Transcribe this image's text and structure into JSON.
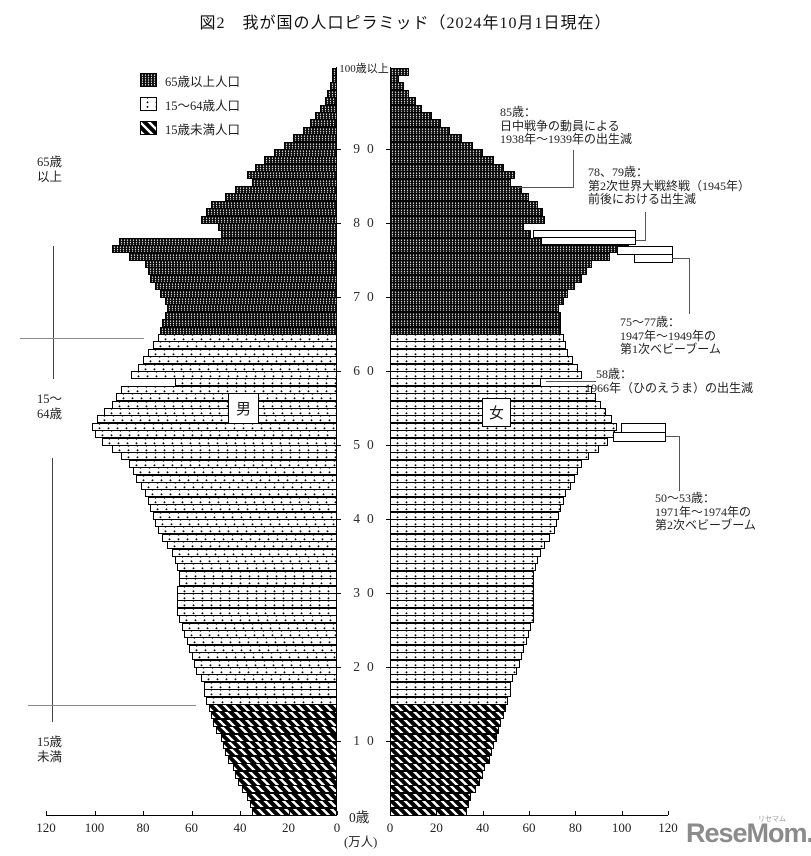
{
  "title": "図2　我が国の人口ピラミッド（2024年10月1日現在）",
  "legend": {
    "items": [
      {
        "key": "elderly",
        "label": "65歳以上人口"
      },
      {
        "key": "working",
        "label": "15～64歳人口"
      },
      {
        "key": "child",
        "label": "15歳未満人口"
      }
    ]
  },
  "side_labels": {
    "elderly": "65歳以上",
    "working": "15～64歳",
    "child": "15歳未満"
  },
  "gender": {
    "male": "男",
    "female": "女"
  },
  "axis": {
    "age_top_label": "100歳以上",
    "age_zero_label": "0歳",
    "unit_label": "(万人)",
    "age_decades": [
      90,
      80,
      70,
      60,
      50,
      40,
      30,
      20,
      10
    ],
    "x_ticks_left": [
      120,
      100,
      80,
      60,
      40,
      20,
      0
    ],
    "x_ticks_right": [
      0,
      20,
      40,
      60,
      80,
      100,
      120
    ]
  },
  "annotations": {
    "a85": {
      "lines": [
        "85歳：",
        "日中戦争の動員による",
        "1938年～1939年の出生減"
      ]
    },
    "a7879": {
      "lines": [
        "78、79歳：",
        "第2次世界大戦終戦（1945年）",
        "前後における出生減"
      ]
    },
    "a7577": {
      "lines": [
        "75～77歳：",
        "1947年～1949年の",
        "第1次ベビーブーム"
      ]
    },
    "a58": {
      "lines": [
        "58歳：",
        "1966年（ひのえうま）の出生減"
      ]
    },
    "a5053": {
      "lines": [
        "50～53歳：",
        "1971年～1974年の",
        "第2次ベビーブーム"
      ]
    }
  },
  "footer": {
    "logo": "ReseMom.",
    "logo_ruby": "リセマム"
  },
  "chart_data": {
    "type": "bar",
    "subtype": "population-pyramid",
    "title": "図2　我が国の人口ピラミッド（2024年10月1日現在）",
    "unit": "万人 per 1-year age group",
    "ages_note": "index = age in years, 0..100 (100 = 100歳以上)",
    "xlim": [
      0,
      120
    ],
    "age_groups": {
      "child": "0-14",
      "working": "15-64",
      "elderly": "65-100"
    },
    "series": [
      {
        "name": "男",
        "values": [
          35,
          36,
          37,
          39,
          41,
          42,
          43,
          45,
          46,
          47,
          48,
          50,
          51,
          52,
          53,
          54,
          55,
          55,
          56,
          58,
          59,
          60,
          61,
          62,
          63,
          64,
          65,
          66,
          66,
          66,
          66,
          65,
          65,
          66,
          67,
          68,
          70,
          72,
          74,
          75,
          76,
          77,
          78,
          79,
          81,
          83,
          84,
          86,
          89,
          93,
          97,
          100,
          101,
          99,
          96,
          93,
          91,
          89,
          67,
          85,
          82,
          80,
          78,
          76,
          74,
          73,
          72,
          71,
          70,
          71,
          73,
          75,
          77,
          78,
          79,
          86,
          93,
          90,
          48,
          49,
          56,
          54,
          52,
          46,
          42,
          35,
          37,
          34,
          30,
          26,
          22,
          18,
          14,
          11,
          9,
          7,
          5,
          4,
          3,
          2,
          2
        ]
      },
      {
        "name": "女",
        "values": [
          33,
          34,
          35,
          37,
          39,
          40,
          41,
          43,
          44,
          45,
          46,
          47,
          48,
          49,
          50,
          51,
          52,
          52,
          53,
          55,
          56,
          57,
          58,
          59,
          60,
          61,
          62,
          62,
          62,
          62,
          62,
          62,
          62,
          63,
          64,
          65,
          67,
          69,
          71,
          72,
          73,
          74,
          75,
          76,
          78,
          80,
          81,
          83,
          86,
          90,
          94,
          97,
          98,
          96,
          93,
          91,
          89,
          87,
          65,
          83,
          81,
          79,
          77,
          76,
          75,
          74,
          74,
          74,
          73,
          75,
          77,
          80,
          83,
          85,
          87,
          95,
          103,
          100,
          61,
          58,
          67,
          66,
          64,
          60,
          57,
          52,
          54,
          49,
          45,
          40,
          36,
          31,
          26,
          22,
          18,
          14,
          11,
          8,
          6,
          4,
          8
        ]
      }
    ]
  }
}
